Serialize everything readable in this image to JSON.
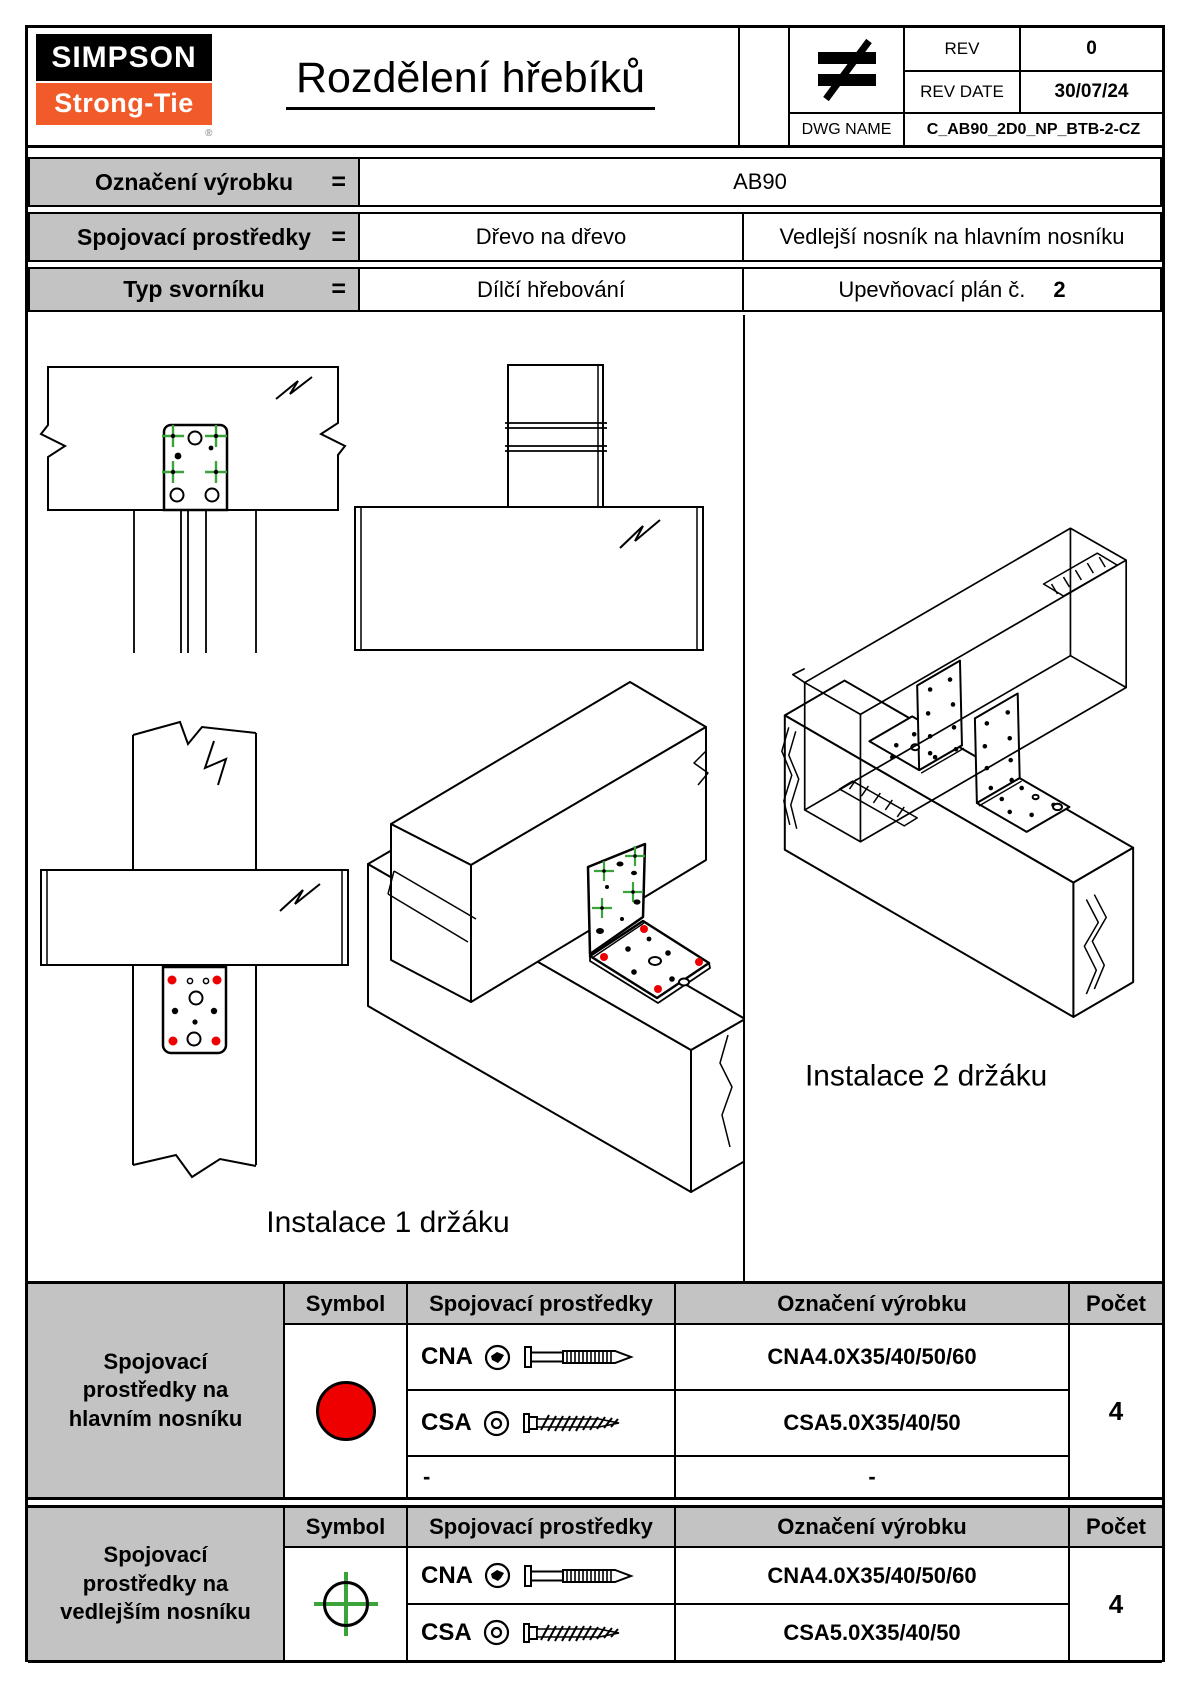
{
  "colors": {
    "header_gray": "#c3c3c3",
    "accent_red": "#ee0000",
    "accent_green": "#3aa43a",
    "logo_orange": "#f15a29",
    "line": "#000000"
  },
  "logo": {
    "top": "SIMPSON",
    "bottom": "Strong-Tie",
    "reg": "®"
  },
  "header": {
    "title": "Rozdělení hřebíků",
    "projection_icon": "not-equal-projection"
  },
  "title_block": {
    "rev_label": "REV",
    "rev_value": "0",
    "rev_date_label": "REV DATE",
    "rev_date_value": "30/07/24",
    "dwg_label": "DWG NAME",
    "dwg_value": "C_AB90_2D0_NP_BTB-2-CZ"
  },
  "info_table": {
    "eq": "=",
    "rows": [
      {
        "label": "Označení výrobku",
        "value": "AB90"
      },
      {
        "label": "Spojovací prostředky",
        "value": "Dřevo na dřevo",
        "value2": "Vedlejší nosník na hlavním nosníku"
      },
      {
        "label": "Typ svorníku",
        "value": "Dílčí hřebování",
        "value2": "Upevňovací plán č.",
        "plan_no": "2"
      }
    ]
  },
  "drawings": {
    "install1_label": "Instalace 1 držáku",
    "install2_label": "Instalace 2 držáku",
    "marker_main_beam": "red-dot",
    "marker_secondary_beam": "green-crosshair"
  },
  "fastener_tables": [
    {
      "group_label": "Spojovací prostředky na hlavním nosníku",
      "headers": {
        "symbol": "Symbol",
        "fastener": "Spojovací prostředky",
        "product": "Označení výrobku",
        "count": "Počet"
      },
      "symbol_icon": "red-filled-circle",
      "rows": [
        {
          "code": "CNA",
          "head_icon": "cna-head",
          "shank_icon": "ring-shank-nail",
          "product": "CNA4.0X35/40/50/60"
        },
        {
          "code": "CSA",
          "head_icon": "csa-head",
          "shank_icon": "wood-screw",
          "product": "CSA5.0X35/40/50"
        },
        {
          "code": "-",
          "product": "-"
        }
      ],
      "count": "4"
    },
    {
      "group_label": "Spojovací prostředky na vedlejším nosníku",
      "headers": {
        "symbol": "Symbol",
        "fastener": "Spojovací prostředky",
        "product": "Označení výrobku",
        "count": "Počet"
      },
      "symbol_icon": "green-crosshair-circle",
      "rows": [
        {
          "code": "CNA",
          "head_icon": "cna-head",
          "shank_icon": "ring-shank-nail",
          "product": "CNA4.0X35/40/50/60"
        },
        {
          "code": "CSA",
          "head_icon": "csa-head",
          "shank_icon": "wood-screw",
          "product": "CSA5.0X35/40/50"
        }
      ],
      "count": "4"
    }
  ]
}
